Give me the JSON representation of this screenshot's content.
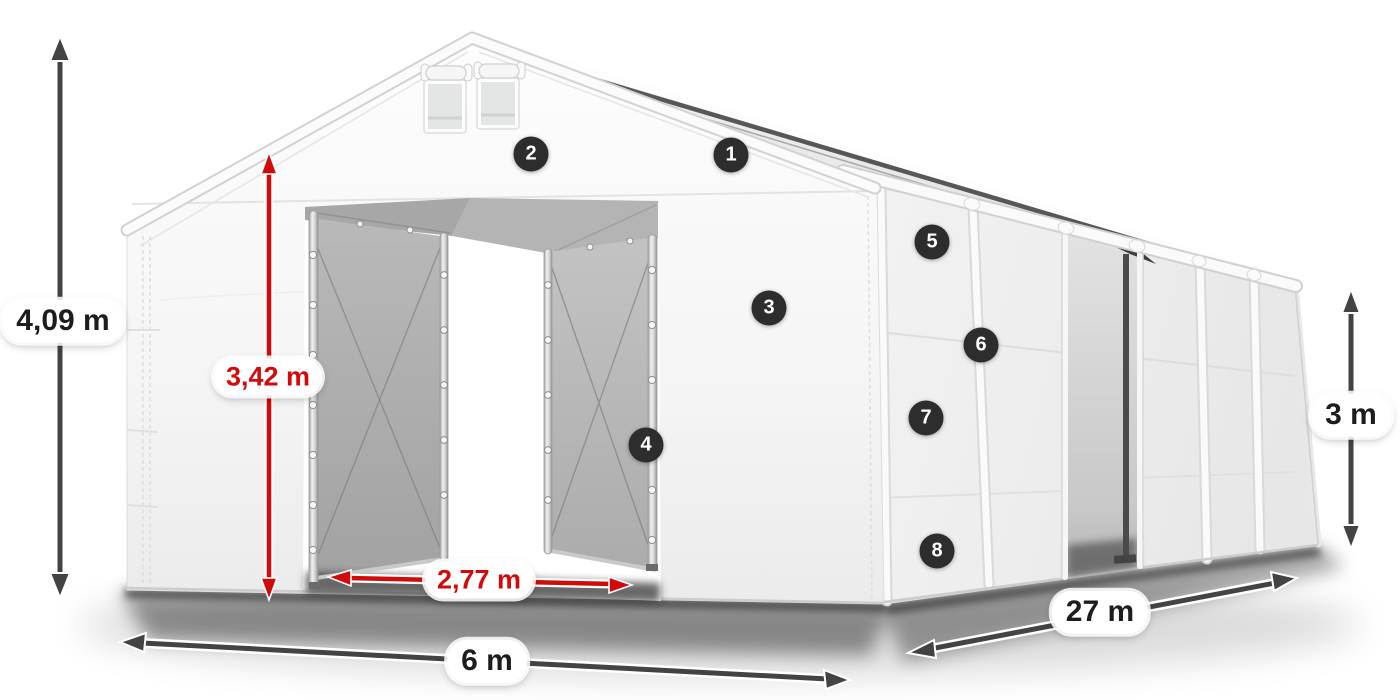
{
  "figure": {
    "type": "product-dimension-diagram",
    "subject": "white storage tent hall with open gable doors"
  },
  "colors": {
    "accent_red": "#d20a0a",
    "arrow_dark": "#434343",
    "badge_bg": "#2d2d2d",
    "badge_text": "#ffffff",
    "fabric_white": "#f4f4f4",
    "interior_gray": "#b0b0b0"
  },
  "dimensions": [
    {
      "id": "total-height",
      "label": "4,09 m",
      "color": "dark"
    },
    {
      "id": "door-height",
      "label": "3,42 m",
      "color": "red"
    },
    {
      "id": "door-width",
      "label": "2,77 m",
      "color": "red"
    },
    {
      "id": "front-width",
      "label": "6 m",
      "color": "dark"
    },
    {
      "id": "length",
      "label": "27 m",
      "color": "dark"
    },
    {
      "id": "side-height",
      "label": "3 m",
      "color": "dark"
    }
  ],
  "badges": [
    {
      "number": "1"
    },
    {
      "number": "2"
    },
    {
      "number": "3"
    },
    {
      "number": "4"
    },
    {
      "number": "5"
    },
    {
      "number": "6"
    },
    {
      "number": "7"
    },
    {
      "number": "8"
    }
  ]
}
